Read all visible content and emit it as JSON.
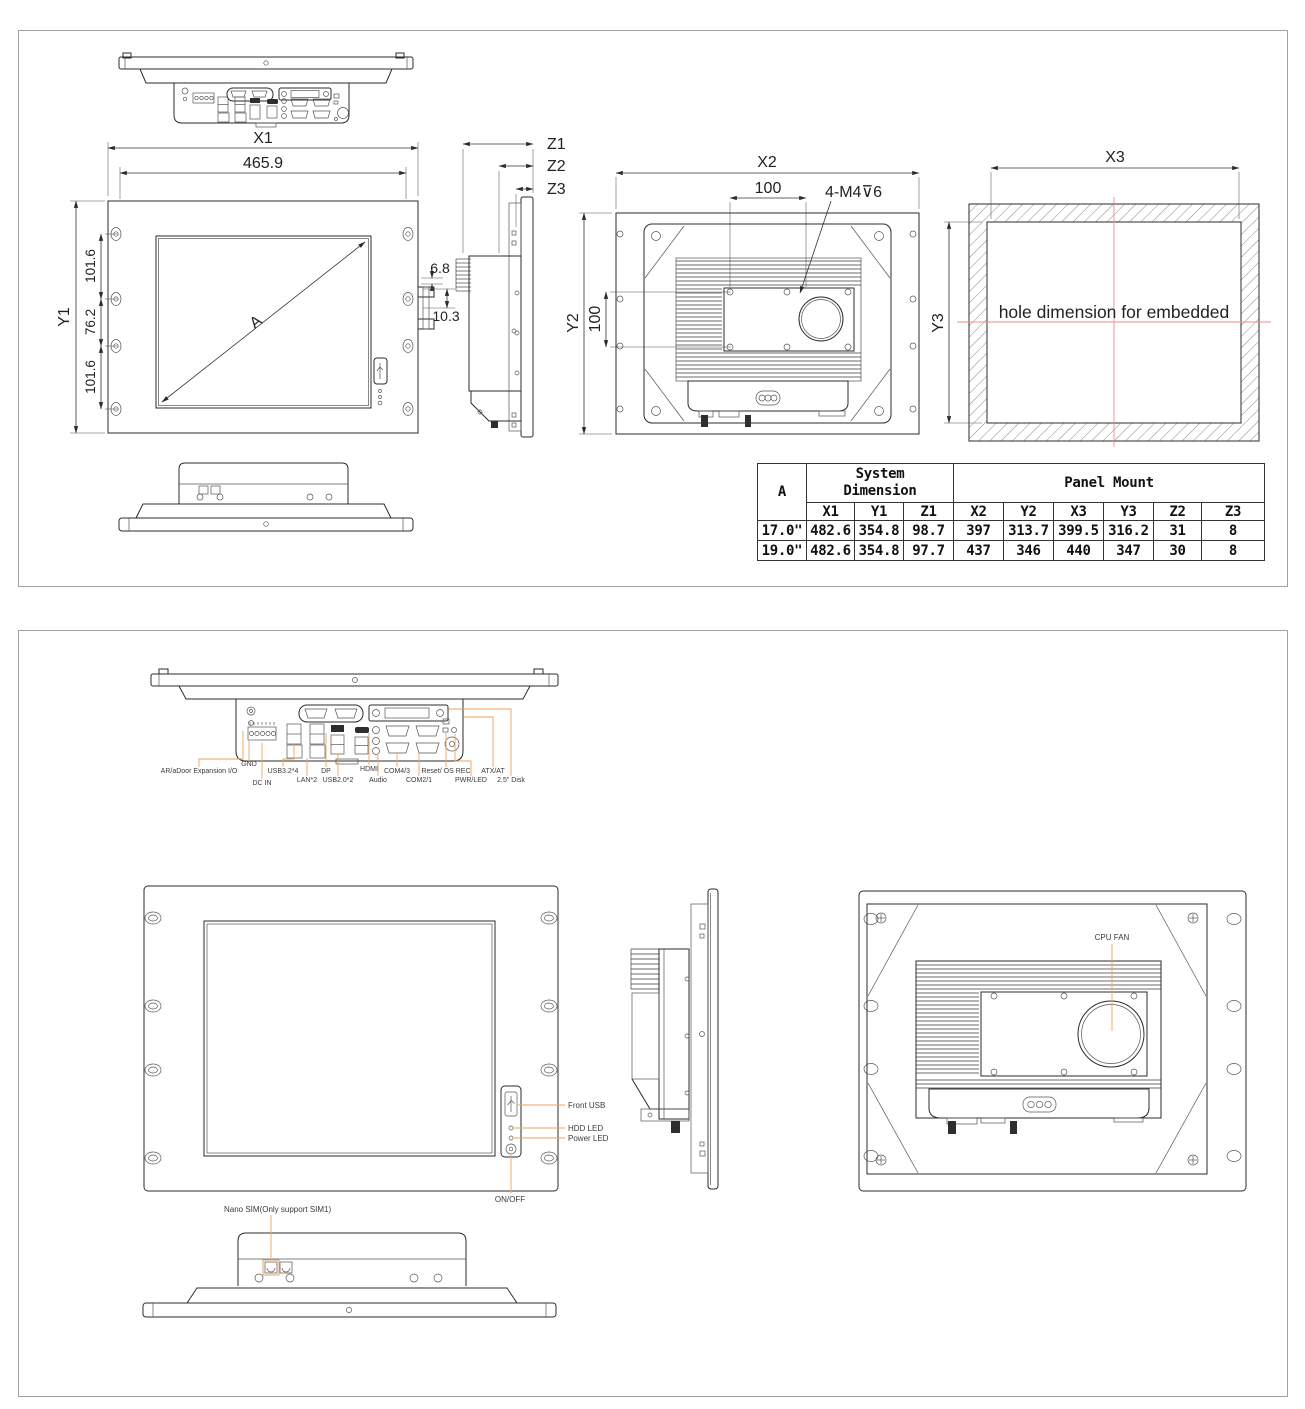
{
  "colors": {
    "line": "#2b2b2b",
    "leader": "#eaa35c",
    "centerline": "#f28b8b",
    "sheet_border": "#a0a0a0",
    "background": "#ffffff"
  },
  "sheet1": {
    "front": {
      "dim_x1": "X1",
      "dim_x1_value": "465.9",
      "dim_y1": "Y1",
      "dim_seg_top": "101.6",
      "dim_seg_mid": "76.2",
      "dim_seg_bot": "101.6",
      "diagonal_label": "A",
      "dim_offset_small": "6.8",
      "dim_offset_large": "10.3"
    },
    "side": {
      "dim_z1": "Z1",
      "dim_z2": "Z2",
      "dim_z3": "Z3"
    },
    "back": {
      "dim_x2": "X2",
      "dim_vesa_h": "100",
      "dim_vesa_v": "100",
      "thread_note": "4-M4⊽6",
      "dim_y2": "Y2"
    },
    "cutout": {
      "dim_x3": "X3",
      "dim_y3": "Y3",
      "note": "hole dimension for embedded"
    },
    "table": {
      "col_a": "A",
      "group1_line1": "System",
      "group1_line2": "Dimension",
      "group2": "Panel Mount",
      "cols": [
        "X1",
        "Y1",
        "Z1",
        "X2",
        "Y2",
        "X3",
        "Y3",
        "Z2",
        "Z3"
      ],
      "row1": [
        "17.0\"",
        "482.6",
        "354.8",
        "98.7",
        "397",
        "313.7",
        "399.5",
        "316.2",
        "31",
        "8"
      ],
      "row2": [
        "19.0\"",
        "482.6",
        "354.8",
        "97.7",
        "437",
        "346",
        "440",
        "347",
        "30",
        "8"
      ]
    }
  },
  "sheet2": {
    "io": {
      "gnd": "GND",
      "expansion": "AR/aDoor Expansion I/O",
      "dc_in": "DC IN",
      "usb3": "USB3.2*4",
      "lan": "LAN*2",
      "dp": "DP",
      "usb2": "USB2.0*2",
      "hdmi": "HDMI",
      "audio": "Audio",
      "com43": "COM4/3",
      "com21": "COM2/1",
      "reset": "Reset/ OS REC",
      "pwr": "PWR/LED",
      "atx": "ATX/AT",
      "disk": "2.5\" Disk"
    },
    "front": {
      "front_usb": "Front USB",
      "hdd_led": "HDD LED",
      "power_led": "Power LED",
      "onoff": "ON/OFF"
    },
    "back": {
      "cpu_fan": "CPU FAN"
    },
    "bottom": {
      "nano_sim": "Nano SIM(Only support SIM1)"
    }
  }
}
